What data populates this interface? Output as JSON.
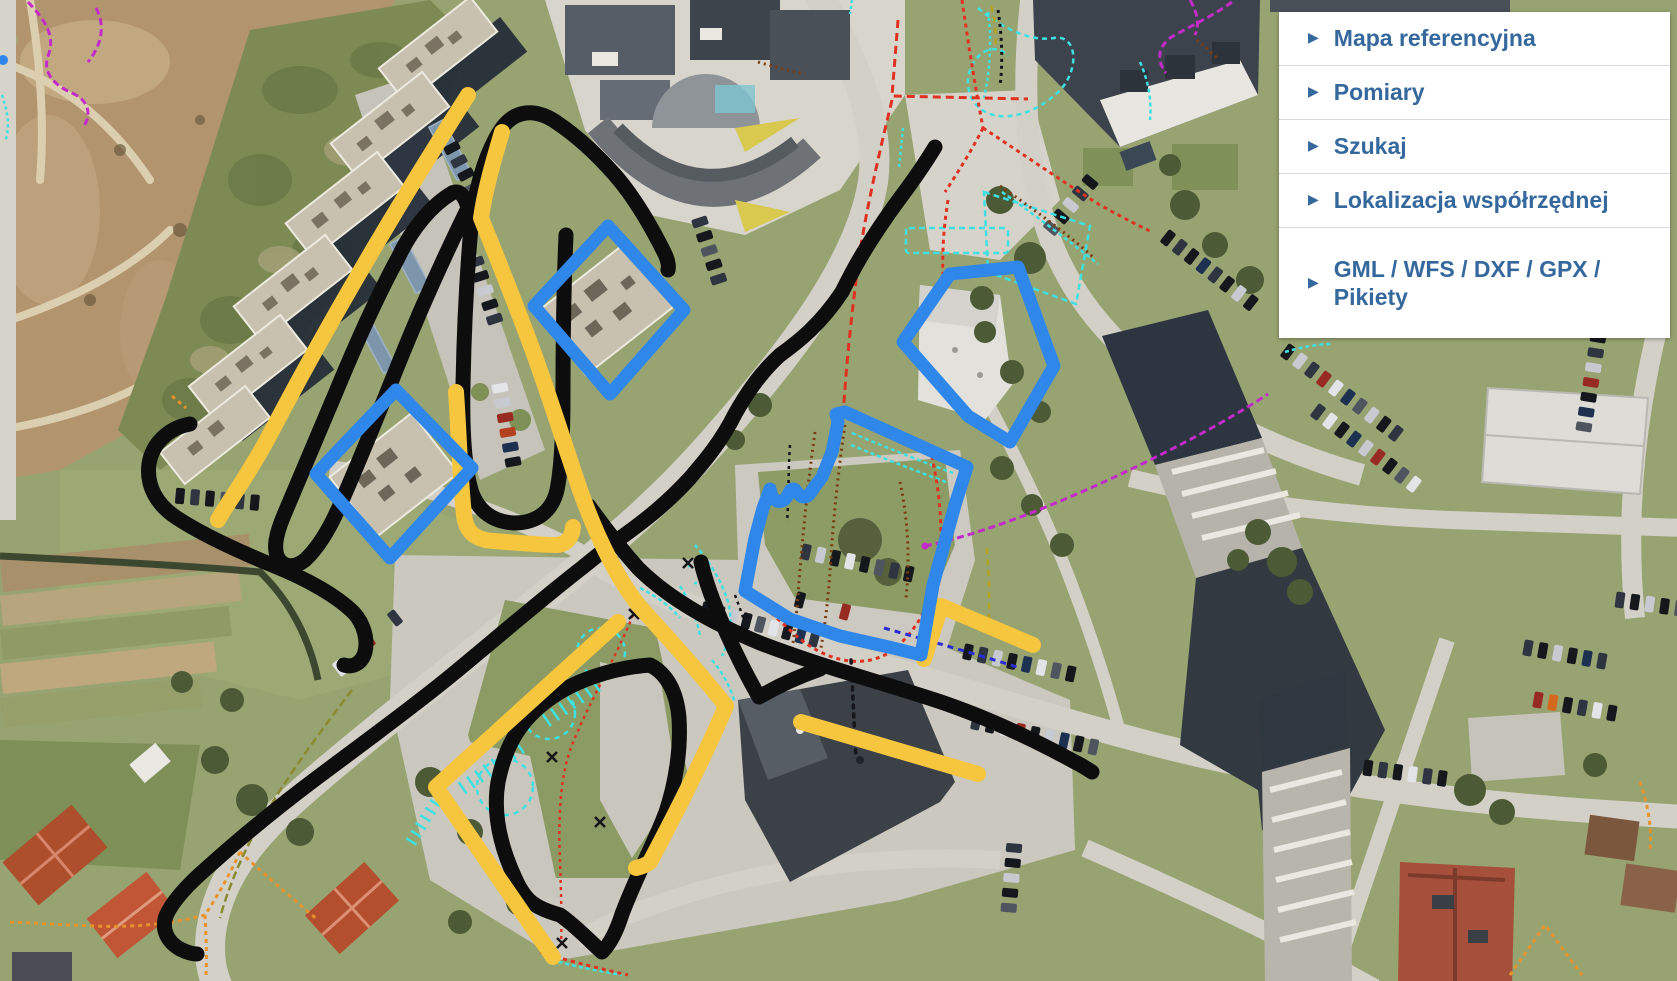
{
  "panel": {
    "background": "#FFFFFF",
    "divider_color": "#D9D9D9",
    "text_color": "#35689D",
    "items": [
      {
        "label": "Mapa referencyjna"
      },
      {
        "label": "Pomiary"
      },
      {
        "label": "Szukaj"
      },
      {
        "label": "Lokalizacja współrzędnej"
      },
      {
        "label": "GML / WFS / DXF / GPX / Pikiety"
      }
    ]
  },
  "map": {
    "annotations": {
      "sketch_black": "#0D0D0D",
      "sketch_yellow": "#F6C63F",
      "sketch_blue": "#2F87EA"
    },
    "overlays": {
      "cyan_dashed": "#3EE1E1",
      "red_dashed": "#DF3222",
      "brown_dotted": "#7B3B10",
      "magenta_dashed": "#C22BC8",
      "orange_dashed": "#E8922A",
      "dark_blue_dashed": "#2B2BD5",
      "olive_dashed": "#B2A320"
    }
  }
}
